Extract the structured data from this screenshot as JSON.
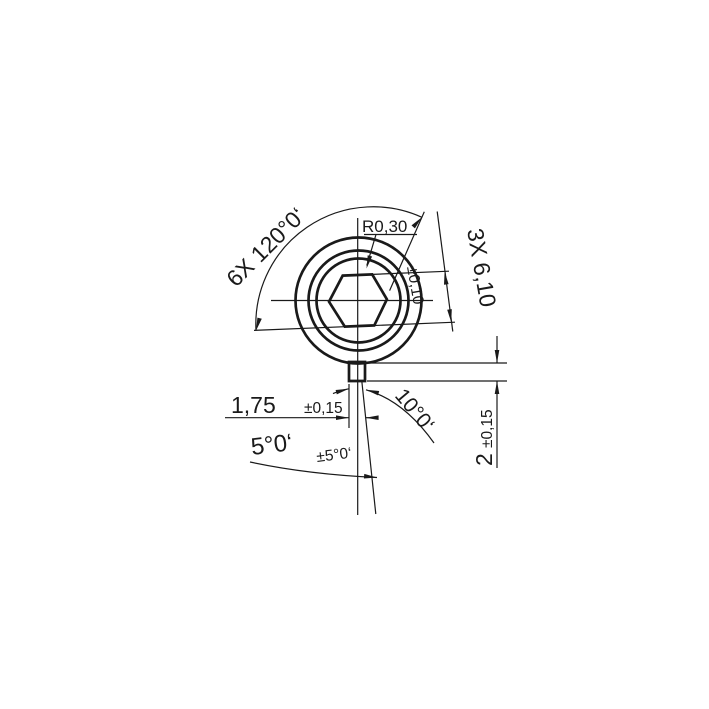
{
  "drawing": {
    "title": "hex-socket-detail-view",
    "background_color": "#ffffff",
    "line_color": "#1a1a1a",
    "annotations": {
      "hex_angle": "6X 120°0‘",
      "corner_radius": "R0,30",
      "across_flats": "3X 6,10",
      "across_flats_tol": "±0,10",
      "tab_width": "1,75",
      "tab_width_tol": "±0,15",
      "taper_angle": "10°0‘",
      "half_taper_angle": "5°0‘",
      "half_taper_angle_tol": "±5°0‘",
      "tab_height": "2",
      "tab_height_tol": "±0,15"
    }
  }
}
